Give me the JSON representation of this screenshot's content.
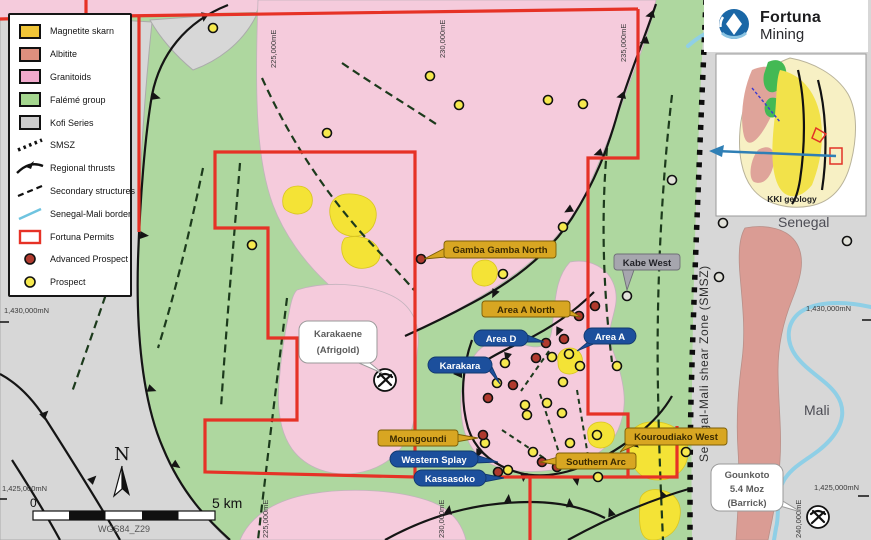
{
  "legend": {
    "items": [
      {
        "label": "Magnetite skarn",
        "symbol": "magnetite-skarn-swatch",
        "color": "#EFC437"
      },
      {
        "label": "Albitite",
        "symbol": "albitite-swatch",
        "color": "#DE8F7E"
      },
      {
        "label": "Granitoids",
        "symbol": "granitoids-swatch",
        "color": "#F2AACD"
      },
      {
        "label": "Falémé group",
        "symbol": "faleme-group-swatch",
        "color": "#A5D78F"
      },
      {
        "label": "Kofi Series",
        "symbol": "kofi-series-swatch",
        "color": "#CCCCCC"
      },
      {
        "label": "SMSZ",
        "symbol": "smsz-line",
        "color": "#111111"
      },
      {
        "label": "Regional thrusts",
        "symbol": "regional-thrusts-line",
        "color": "#111111"
      },
      {
        "label": "Secondary structures",
        "symbol": "secondary-structures-line",
        "color": "#111111"
      },
      {
        "label": "Senegal-Mali border",
        "symbol": "senegal-mali-border-line",
        "color": "#6FC4E0"
      },
      {
        "label": "Fortuna Permits",
        "symbol": "fortuna-permits-outline",
        "color": "#E63226"
      },
      {
        "label": "Advanced Prospect",
        "symbol": "advanced-prospect-dot",
        "color": "#B03A2E"
      },
      {
        "label": "Prospect",
        "symbol": "prospect-dot",
        "color": "#F6E94E"
      }
    ]
  },
  "logo": {
    "title": "Fortuna",
    "subtitle": "Mining"
  },
  "inset": {
    "caption": "KKI geology"
  },
  "map": {
    "regions": {
      "senegal": "Senegal",
      "mali": "Mali",
      "shear_zone": "Senegal-Mali shear Zone  (SMSZ)"
    },
    "coordinates": {
      "top": [
        "225,000mE",
        "230,000mE",
        "235,000mE"
      ],
      "bottom": [
        "225,000mE",
        "230,000mE",
        "240,000mE"
      ],
      "left": [
        "1,430,000mN",
        "1,425,000mN"
      ],
      "right": [
        "1,430,000mN",
        "1,425,000mN"
      ]
    },
    "scale": {
      "start": "0",
      "end": "5 km",
      "datum": "WGS84_Z29"
    },
    "north": "N"
  },
  "badges": [
    {
      "label": "Gamba Gamba North",
      "style": "gold"
    },
    {
      "label": "Area A North",
      "style": "gold"
    },
    {
      "label": "Area D",
      "style": "blue"
    },
    {
      "label": "Area A",
      "style": "blue"
    },
    {
      "label": "Karakara",
      "style": "blue"
    },
    {
      "label": "Moungoundi",
      "style": "gold"
    },
    {
      "label": "Western Splay",
      "style": "blue"
    },
    {
      "label": "Kassasoko",
      "style": "blue"
    },
    {
      "label": "Southern Arc",
      "style": "gold"
    },
    {
      "label": "Kouroudiako West",
      "style": "gold"
    },
    {
      "label": "Kabe West",
      "style": "gray"
    }
  ],
  "callouts": {
    "karakaene": {
      "line1": "Karakaene",
      "line2": "(Afrigold)"
    },
    "gounkoto": {
      "line1": "Gounkoto",
      "line2": "5.4 Moz",
      "line3": "(Barrick)"
    }
  },
  "prospects": {
    "advanced": [
      [
        421,
        259
      ],
      [
        579,
        316
      ],
      [
        595,
        306
      ],
      [
        564,
        339
      ],
      [
        546,
        343
      ],
      [
        536,
        358
      ],
      [
        513,
        385
      ],
      [
        488,
        398
      ],
      [
        483,
        435
      ],
      [
        498,
        472
      ],
      [
        542,
        462
      ],
      [
        557,
        467
      ]
    ],
    "prospect": [
      [
        213,
        28
      ],
      [
        430,
        76
      ],
      [
        459,
        105
      ],
      [
        548,
        100
      ],
      [
        583,
        104
      ],
      [
        327,
        133
      ],
      [
        563,
        227
      ],
      [
        252,
        245
      ],
      [
        503,
        274
      ],
      [
        552,
        357
      ],
      [
        569,
        354
      ],
      [
        505,
        363
      ],
      [
        580,
        366
      ],
      [
        617,
        366
      ],
      [
        497,
        383
      ],
      [
        563,
        382
      ],
      [
        525,
        405
      ],
      [
        547,
        403
      ],
      [
        562,
        413
      ],
      [
        527,
        415
      ],
      [
        485,
        443
      ],
      [
        570,
        443
      ],
      [
        533,
        452
      ],
      [
        508,
        470
      ],
      [
        597,
        435
      ],
      [
        598,
        477
      ],
      [
        686,
        452
      ]
    ],
    "unlabeled": [
      [
        627,
        296
      ],
      [
        672,
        180
      ],
      [
        723,
        223
      ],
      [
        847,
        241
      ],
      [
        719,
        277
      ]
    ]
  },
  "colors": {
    "granitoids": "#F5CBDC",
    "faleme_group": "#AED79F",
    "kofi_series": "#D7D7D7",
    "magnetite_skarn": "#F4E336",
    "albitite": "#DA9C94",
    "permit_red": "#E63226",
    "border_blue": "#8FCFE6",
    "badge_gold": "#D8A622",
    "badge_blue": "#1C4F9C"
  }
}
